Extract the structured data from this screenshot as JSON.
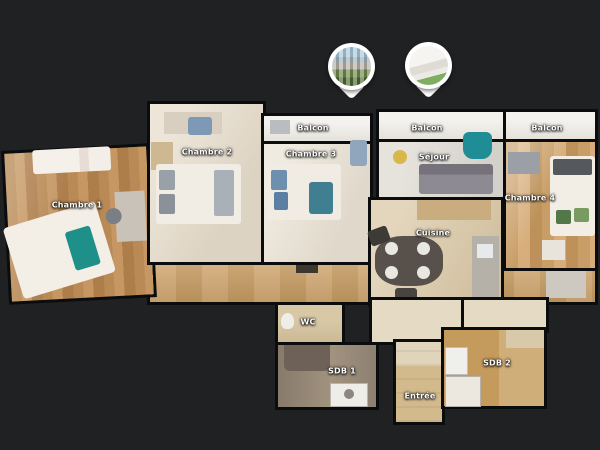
{
  "view": {
    "background_color": "#1f2123",
    "wall_color": "#0b0c0d",
    "label_color": "#ffffff"
  },
  "pins": [
    {
      "name": "exterior-city-photo-pin"
    },
    {
      "name": "balcony-interior-photo-pin"
    }
  ],
  "rooms": [
    {
      "id": "chambre1",
      "label": "Chambre 1"
    },
    {
      "id": "chambre2",
      "label": "Chambre 2"
    },
    {
      "id": "balcon1",
      "label": "Balcon"
    },
    {
      "id": "chambre3",
      "label": "Chambre 3"
    },
    {
      "id": "balcon2",
      "label": "Balcon"
    },
    {
      "id": "sejour",
      "label": "Séjour"
    },
    {
      "id": "cuisine",
      "label": "Cuisine"
    },
    {
      "id": "balcon3",
      "label": "Balcon"
    },
    {
      "id": "chambre4",
      "label": "Chambre 4"
    },
    {
      "id": "wc",
      "label": "WC"
    },
    {
      "id": "sdb1",
      "label": "SDB 1"
    },
    {
      "id": "entree",
      "label": "Entrée"
    },
    {
      "id": "sdb2",
      "label": "SDB 2"
    }
  ]
}
